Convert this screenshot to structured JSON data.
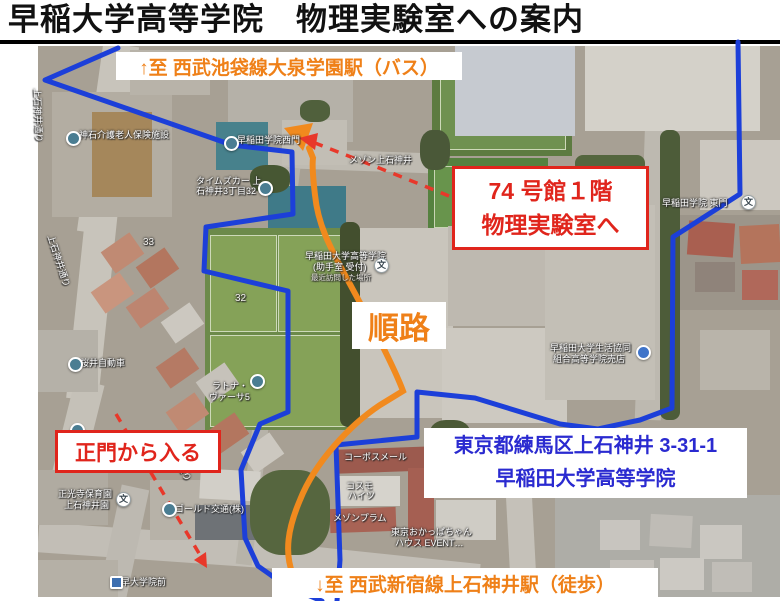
{
  "title": "早稲大学高等学院　物理実験室への案内",
  "banners": {
    "top": "↑至 西武池袋線大泉学園駅（バス）",
    "bottom": "↓至 西武新宿線上石神井駅（徒歩）"
  },
  "callouts": {
    "building": {
      "line1": "74 号館１階",
      "line2": "物理実験室へ"
    },
    "route_label": "順路",
    "gate": "正門から入る",
    "address": {
      "line1": "東京都練馬区上石神井 3-31-1",
      "line2": "早稲田大学高等学院"
    }
  },
  "colors": {
    "accent_orange": "#ef8018",
    "accent_red": "#e0251c",
    "accent_blue_text": "#2a2ad0",
    "boundary_blue": "#1c3fd9",
    "route_orange": "#f18a1e"
  },
  "map_labels": [
    {
      "text": "上石神井通り",
      "x": 44,
      "y": 88,
      "rot": 88
    },
    {
      "text": "神石介護老人保険施設",
      "x": 79,
      "y": 128
    },
    {
      "text": "早稲田学院西門",
      "x": 237,
      "y": 133
    },
    {
      "text": "タイムズカー  上",
      "x": 196,
      "y": 174
    },
    {
      "text": "石神井3丁目32",
      "x": 196,
      "y": 184
    },
    {
      "text": "メゾン上石神井",
      "x": 349,
      "y": 153
    },
    {
      "text": "33",
      "x": 143,
      "y": 237,
      "cls": "num"
    },
    {
      "text": "32",
      "x": 235,
      "y": 293,
      "cls": "num"
    },
    {
      "text": "早稲田大学高等学院",
      "x": 305,
      "y": 249
    },
    {
      "text": "(助手室 受付)",
      "x": 313,
      "y": 260
    },
    {
      "text": "最近訪問した場所",
      "x": 311,
      "y": 272,
      "cls": "dim"
    },
    {
      "text": "早稲田学院 東門",
      "x": 662,
      "y": 196
    },
    {
      "text": "早稲田大学生活協同",
      "x": 550,
      "y": 341
    },
    {
      "text": "組合高等学院売店",
      "x": 553,
      "y": 352
    },
    {
      "text": "桜井自動車",
      "x": 80,
      "y": 356
    },
    {
      "text": "上石神井通り",
      "x": 57,
      "y": 233,
      "rot": 72
    },
    {
      "text": "上石神井通り",
      "x": 168,
      "y": 430,
      "rot": 60
    },
    {
      "text": "ラトナ・",
      "x": 212,
      "y": 379
    },
    {
      "text": "ヴァーサ5",
      "x": 209,
      "y": 390
    },
    {
      "text": "正光寺保育園",
      "x": 58,
      "y": 487
    },
    {
      "text": "上石神井園",
      "x": 64,
      "y": 498
    },
    {
      "text": "ゴールド交通(株)",
      "x": 175,
      "y": 502
    },
    {
      "text": "早大学院前",
      "x": 121,
      "y": 575
    },
    {
      "text": "コーポスメール",
      "x": 344,
      "y": 450
    },
    {
      "text": "コスモ",
      "x": 346,
      "y": 479
    },
    {
      "text": "ハイツ",
      "x": 348,
      "y": 489
    },
    {
      "text": "メゾンプラム",
      "x": 333,
      "y": 511
    },
    {
      "text": "東京おかっぱちゃん",
      "x": 391,
      "y": 525
    },
    {
      "text": "ハウス EVENT…",
      "x": 395,
      "y": 536
    }
  ],
  "map_pins": [
    {
      "type": "generic",
      "x": 66,
      "y": 131
    },
    {
      "type": "generic",
      "x": 224,
      "y": 136
    },
    {
      "type": "generic",
      "x": 258,
      "y": 181
    },
    {
      "type": "school",
      "x": 374,
      "y": 258,
      "glyph": "文"
    },
    {
      "type": "school",
      "x": 741,
      "y": 195,
      "glyph": "文"
    },
    {
      "type": "shop",
      "x": 636,
      "y": 345
    },
    {
      "type": "generic",
      "x": 68,
      "y": 357
    },
    {
      "type": "generic",
      "x": 250,
      "y": 374
    },
    {
      "type": "generic",
      "x": 70,
      "y": 423
    },
    {
      "type": "school",
      "x": 116,
      "y": 492,
      "glyph": "文"
    },
    {
      "type": "generic",
      "x": 162,
      "y": 502
    },
    {
      "type": "bus",
      "x": 110,
      "y": 576
    }
  ]
}
